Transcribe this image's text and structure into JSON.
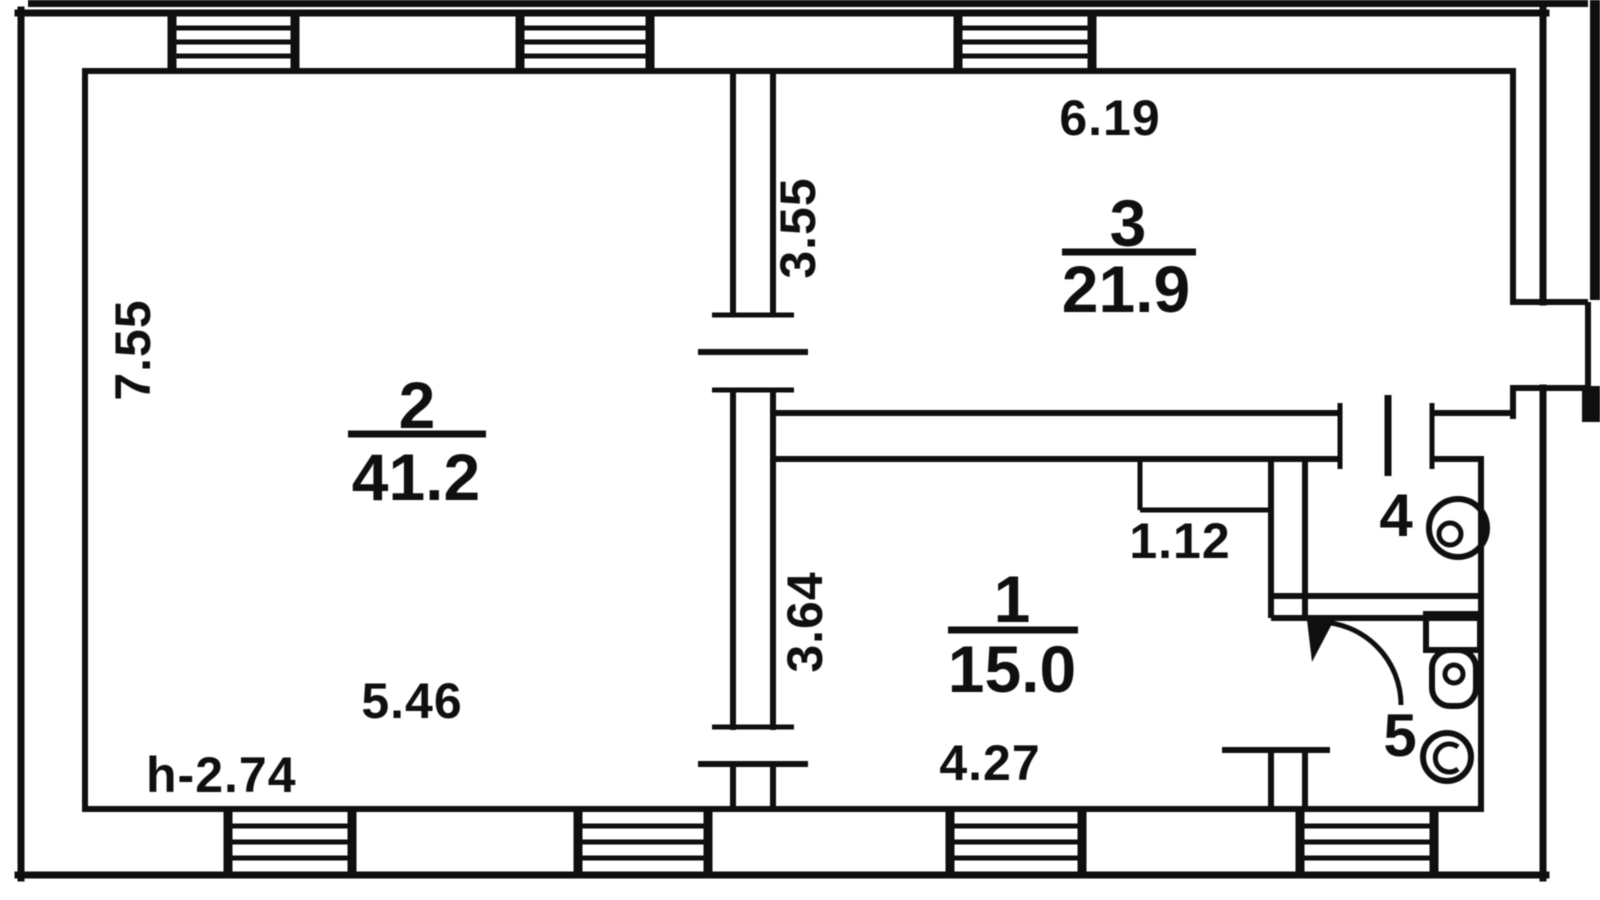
{
  "colors": {
    "ink": "#141414",
    "paper": "#ffffff"
  },
  "rooms": {
    "room1": {
      "number": "1",
      "area": "15.0",
      "dim_width": "4.27",
      "dim_height": "3.64",
      "dim_notch": "1.12"
    },
    "room2": {
      "number": "2",
      "area": "41.2",
      "dim_width": "5.46",
      "dim_height": "7.55",
      "ceiling_height": "h-2.74"
    },
    "room3": {
      "number": "3",
      "area": "21.9",
      "dim_width": "6.19",
      "dim_height": "3.55"
    },
    "room4": {
      "number": "4"
    },
    "room5": {
      "number": "5"
    }
  }
}
